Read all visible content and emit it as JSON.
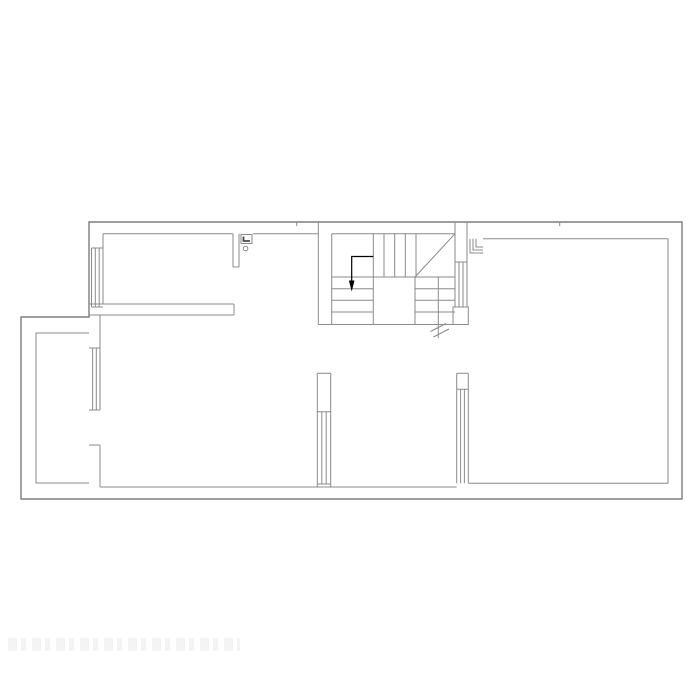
{
  "page": {
    "background": "#ffffff"
  },
  "drawing": {
    "kind": "architectural-floor-plan",
    "colors": {
      "background": "#ffffff",
      "line": "#8a8a8a",
      "outer_line": "#7d7d7d",
      "dark_detail": "#4a4a4a",
      "arrow": "#000000",
      "watermark": "#f3f3f3"
    },
    "features": [
      "exterior-walls",
      "left-annex",
      "top-left-room",
      "u-shaped-staircase",
      "stair-direction-arrow",
      "stair-break-line",
      "window-top-left-wall",
      "window-lower-left-wall",
      "window-stair-right-wall",
      "window-bottom-left-pier",
      "window-bottom-right-pier",
      "door-frame-detail-left",
      "door-frame-detail-right",
      "door-pivot-circle"
    ],
    "watermark": {
      "present": true,
      "legible": false,
      "text": ""
    }
  }
}
